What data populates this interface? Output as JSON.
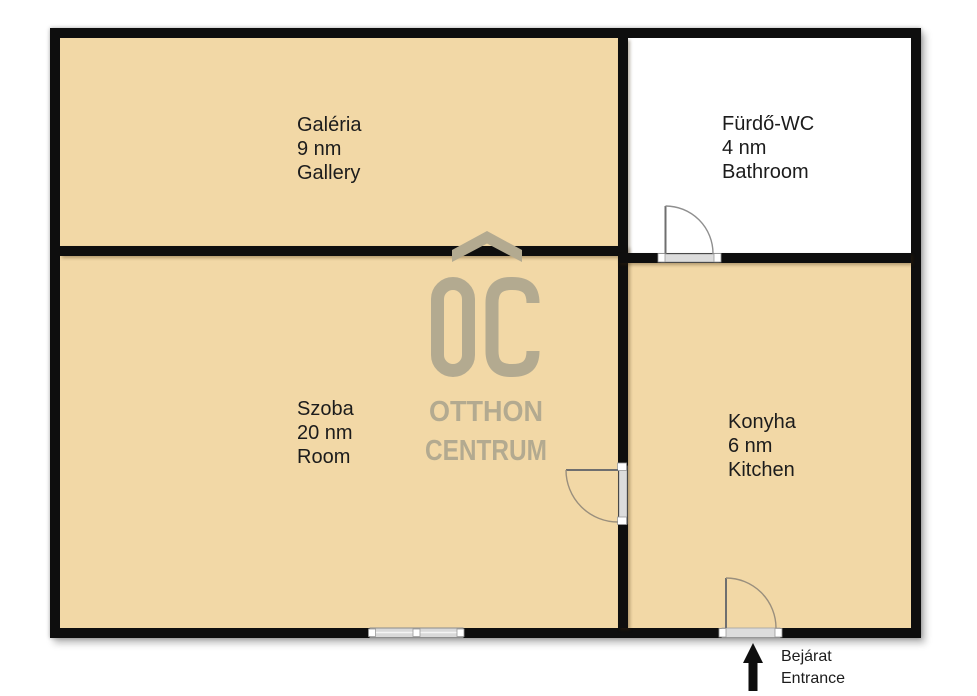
{
  "rooms": [
    {
      "name_local": "Galéria",
      "area": "9 nm",
      "name_en": "Gallery"
    },
    {
      "name_local": "Fürdő-WC",
      "area": "4 nm",
      "name_en": "Bathroom"
    },
    {
      "name_local": "Szoba",
      "area": "20 nm",
      "name_en": "Room"
    },
    {
      "name_local": "Konyha",
      "area": "6 nm",
      "name_en": "Kitchen"
    }
  ],
  "entrance": {
    "label_local": "Bejárat",
    "label_en": "Entrance"
  },
  "watermark": {
    "monogram": "OC",
    "word1": "OTTHON",
    "word2": "CENTRUM"
  },
  "colors": {
    "room_fill": "#f2d8a6",
    "bathroom_fill": "#ffffff",
    "wall": "#0e0e0e",
    "watermark": "#b3aa90",
    "door_line": "#8f8f8f",
    "threshold_fill": "#dcdcdc",
    "label_text": "#1c1c1c"
  }
}
